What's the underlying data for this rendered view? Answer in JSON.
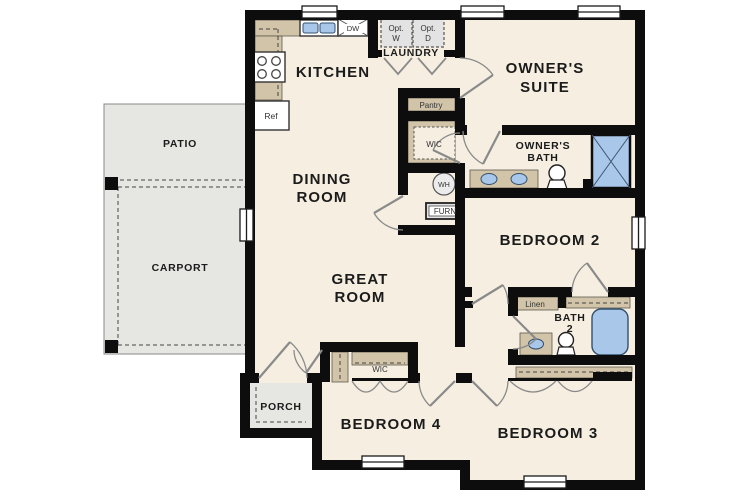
{
  "rooms": {
    "patio": {
      "label": "PATIO"
    },
    "carport": {
      "label": "CARPORT"
    },
    "porch": {
      "label": "PORCH"
    },
    "kitchen": {
      "label": "KITCHEN"
    },
    "dining_room": {
      "line1": "DINING",
      "line2": "ROOM"
    },
    "great_room": {
      "line1": "GREAT",
      "line2": "ROOM"
    },
    "owners_suite": {
      "line1": "OWNER'S",
      "line2": "SUITE"
    },
    "owners_bath": {
      "line1": "OWNER'S",
      "line2": "BATH"
    },
    "laundry": {
      "label": "LAUNDRY"
    },
    "bedroom_2": {
      "label": "BEDROOM 2"
    },
    "bedroom_3": {
      "label": "BEDROOM 3"
    },
    "bedroom_4": {
      "label": "BEDROOM 4"
    },
    "bath_2": {
      "line1": "BATH",
      "line2": "2"
    }
  },
  "fixtures": {
    "dishwasher": "DW",
    "refrigerator": "Ref",
    "pantry": "Pantry",
    "owners_wic": "WIC",
    "bedroom4_wic": "WIC",
    "water_heater": "WH",
    "furnace": "FURN",
    "linen": "Linen",
    "optional_washer": {
      "line1": "Opt.",
      "line2": "W"
    },
    "optional_dryer": {
      "line1": "Opt.",
      "line2": "D"
    }
  },
  "colors": {
    "wall": "#0d0d0d",
    "floor": "#f5eee1",
    "outdoor": "#e6e6e3",
    "cabinet": "#d2c4a8",
    "plumbing_blue": "#a9c7e9",
    "appliance_gray": "#e3e3e3"
  }
}
